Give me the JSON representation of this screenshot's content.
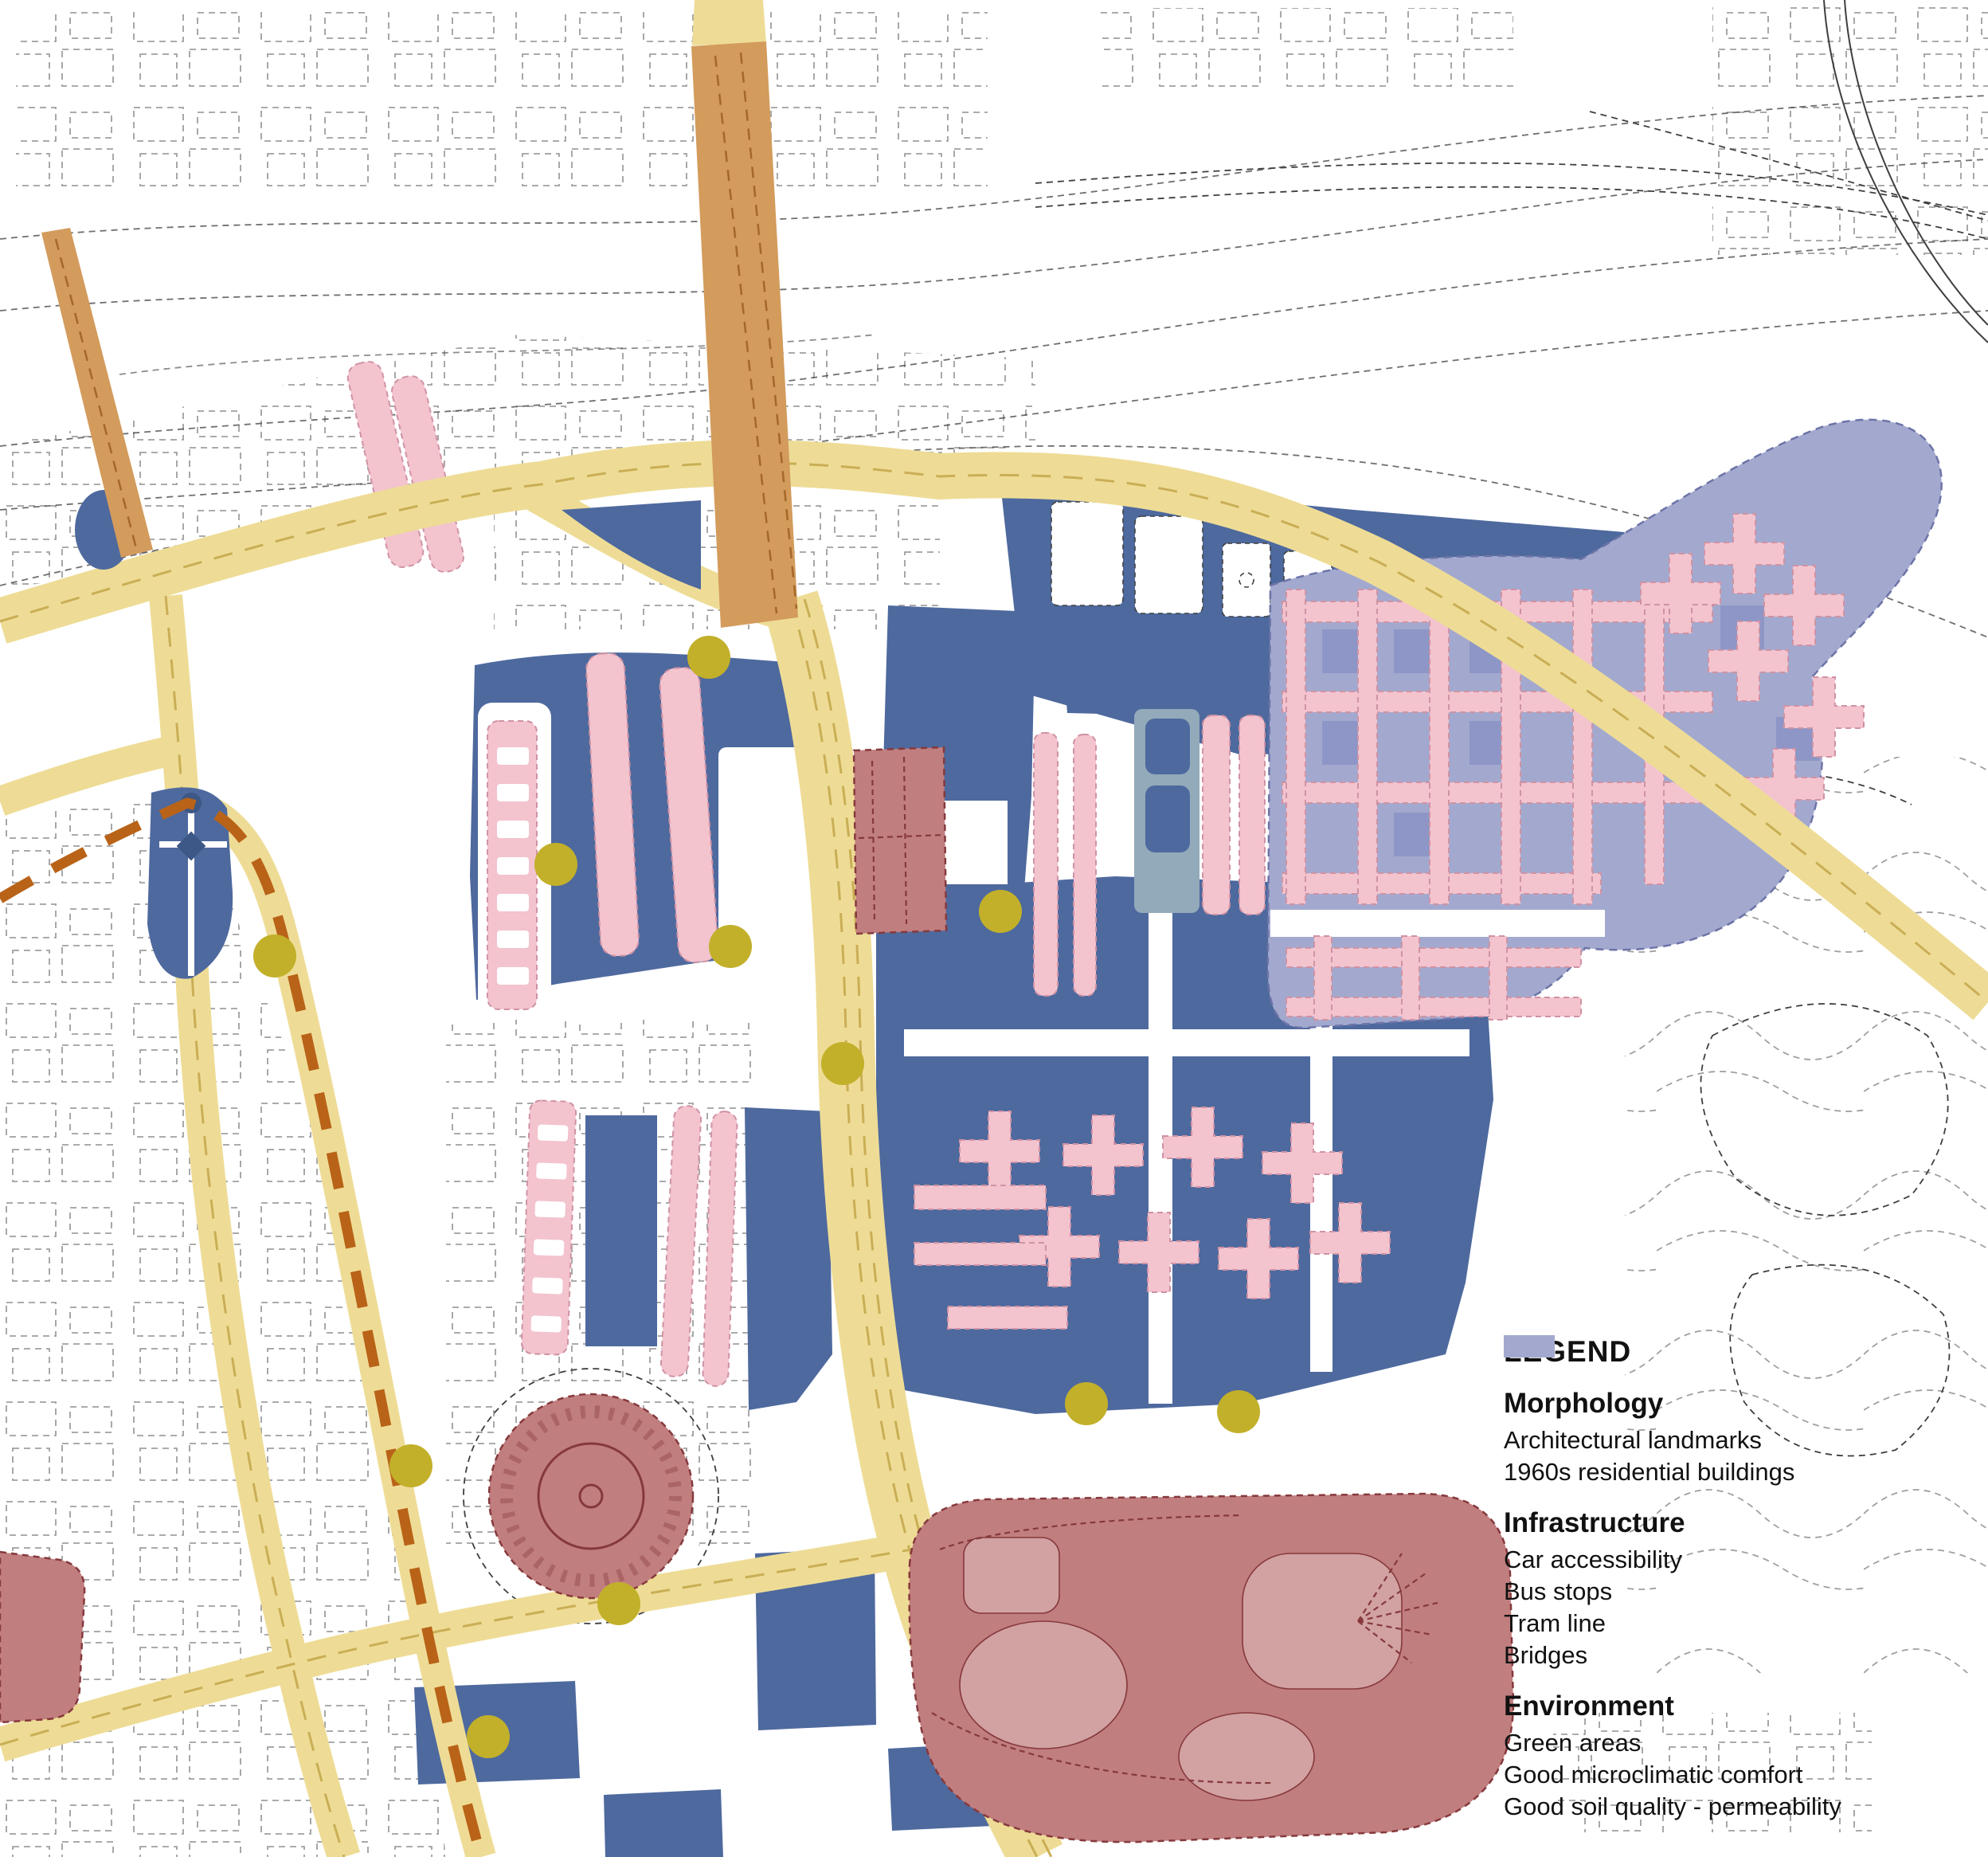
{
  "legend": {
    "title": "LEGEND",
    "sections": [
      {
        "heading": "Morphology",
        "items": [
          {
            "label": "Architectural landmarks",
            "swatch": "landmark",
            "shape": "rect"
          },
          {
            "label": "1960s residential buildings",
            "swatch": "residential",
            "shape": "rect"
          }
        ]
      },
      {
        "heading": "Infrastructure",
        "items": [
          {
            "label": "Car accessibility",
            "swatch": "road",
            "shape": "rect"
          },
          {
            "label": "Bus stops",
            "swatch": "bus_stop",
            "shape": "circle"
          },
          {
            "label": "Tram line",
            "swatch": "tram",
            "shape": "dashed-line"
          },
          {
            "label": "Bridges",
            "swatch": "bridge",
            "shape": "rect"
          }
        ]
      },
      {
        "heading": "Environment",
        "items": [
          {
            "label": "Green areas",
            "swatch": "green_area",
            "shape": "rect"
          },
          {
            "label": "Good microclimatic comfort",
            "swatch": "microclimate",
            "shape": "rect"
          },
          {
            "label": "Good soil quality - permeability",
            "swatch": "soil",
            "shape": "rect"
          }
        ]
      }
    ]
  },
  "colors": {
    "line": "#3f3f3f",
    "road": "#eedc96",
    "road_dash": "#c9ae55",
    "bridge": "#d39b5c",
    "tram": "#b96318",
    "bus_stop": "#c2b02a",
    "green_area": "#4e699e",
    "microclimate": "#92aaba",
    "soil": "#a3a9ce",
    "residential": "#f3c3ce",
    "residential_stroke": "#cf93a4",
    "landmark": "#c17e7f",
    "landmark_dark": "#86393c",
    "text": "#111111"
  },
  "map": {
    "bus_stop_radius": 27,
    "bus_stops": [
      [
        890,
        825
      ],
      [
        698,
        1085
      ],
      [
        345,
        1200
      ],
      [
        917,
        1188
      ],
      [
        1058,
        1335
      ],
      [
        1256,
        1144
      ],
      [
        1364,
        1762
      ],
      [
        1555,
        1772
      ],
      [
        516,
        1840
      ],
      [
        777,
        2013
      ],
      [
        613,
        2180
      ]
    ]
  }
}
